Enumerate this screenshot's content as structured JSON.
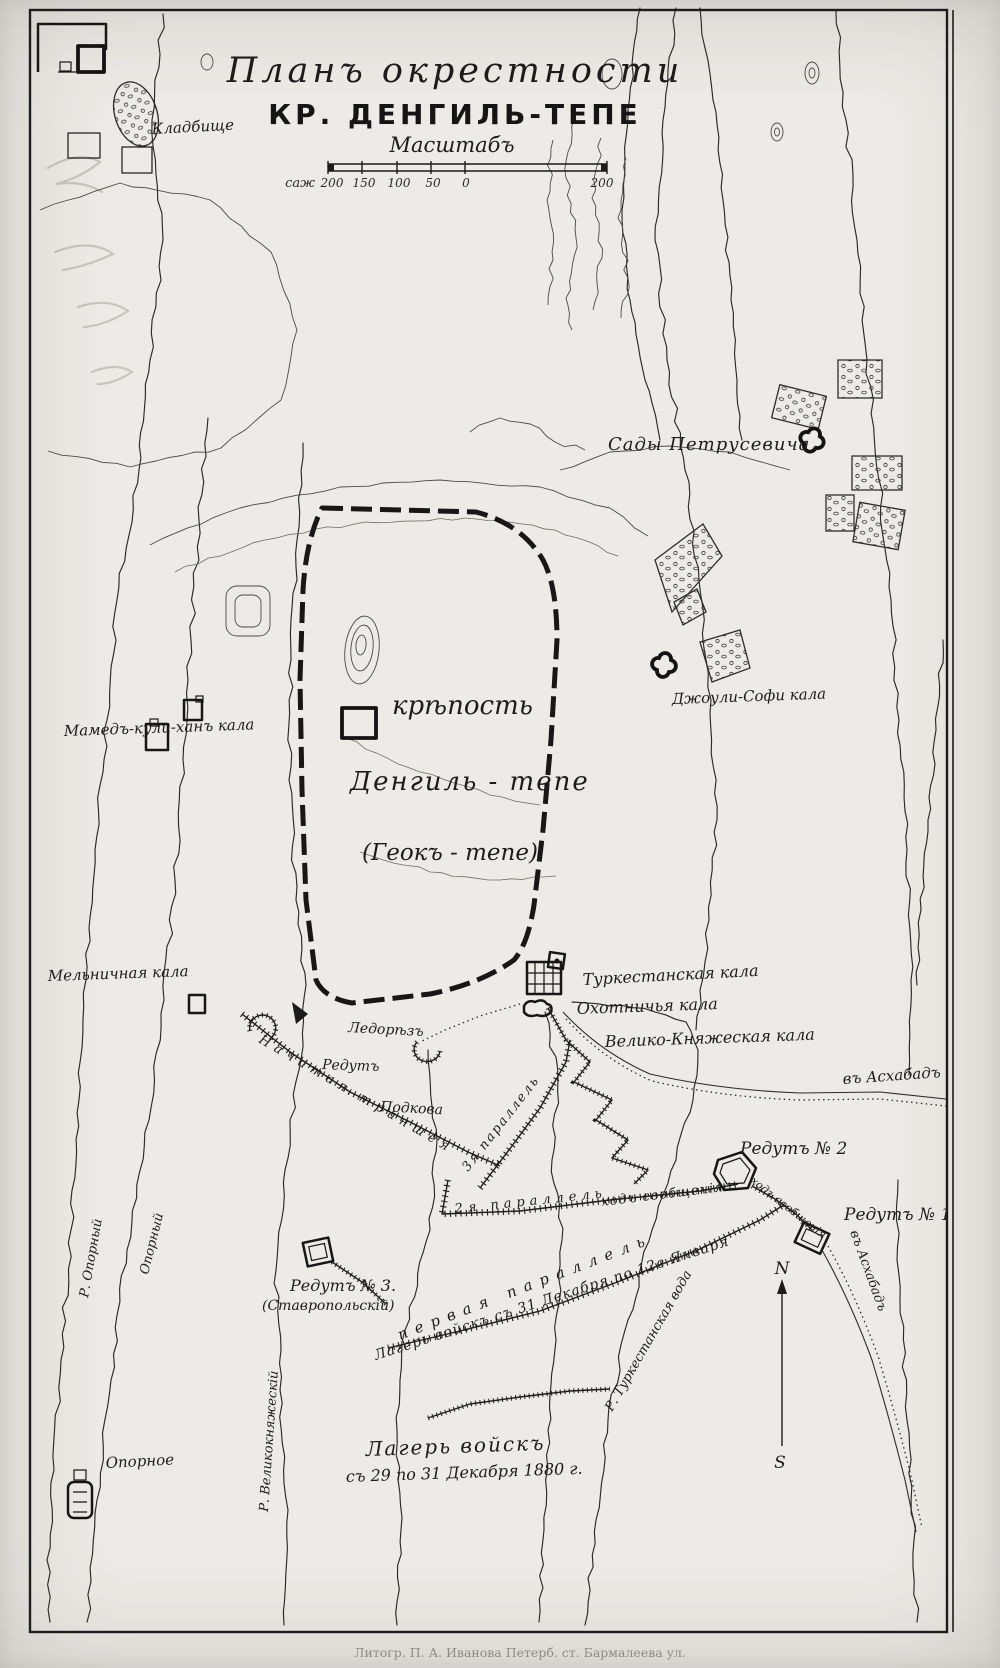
{
  "title": {
    "line1": "Планъ окрестности",
    "line2": "КР. ДЕНГИЛЬ-ТЕПЕ",
    "scale_heading": "Масштабъ"
  },
  "scale_bar": {
    "unit": "саж",
    "tick_200": "200",
    "tick_150": "150",
    "tick_100": "100",
    "tick_50": "50",
    "tick_0": "0",
    "right_end": "200"
  },
  "labels": {
    "cemetery": "Кладбище",
    "petrusevich_gardens": "Сады Петрусевича",
    "fortress_word": "крѣпость",
    "fortress_name": "Денгиль - тепе",
    "fortress_alt_name": "(Геокъ - тепе)",
    "mamed_kuli_khan_kala": "Мамедъ-кули-ханъ кала",
    "dzhouli_sofi_kala": "Джоули-Софи кала",
    "melnichnaya_kala": "Мельничная кала",
    "turkestanskaya_kala": "Туркестанская кала",
    "okhotnichya_kala": "Охотничья кала",
    "veliko_knyazheskaya_kala": "Велико-Княжеская кала",
    "ledorez": "Ледорѣзъ",
    "redut": "Редутъ",
    "podkova": "Подкова",
    "nachataya_transheya": "Начатая траншея",
    "parallel_3": "3я параллель",
    "parallel_2": "2я параллель",
    "khod_soobshcheniya": "ходъ сообщенія",
    "khod_soobshcheniya_2": "ходъ сообщенія",
    "redut_2": "Редутъ № 2",
    "redut_1": "Редутъ № 1",
    "redut_3": "Редутъ № 3.",
    "redut_3_sub": "(Ставропольскій)",
    "pervaya_parallel": "первая параллель",
    "camp_dec31_jan12": "Лагерь войскъ съ 31 Декабря по 12е Января",
    "camp_dec29_line1": "Лагерь войскъ",
    "camp_dec29_line2": "съ 29 по 31 Декабря 1880 г.",
    "opornoe": "Опорное",
    "r_oporny": "Р. Опорный",
    "oporny": "Опорный",
    "r_velikoknyazhesky": "Р. Великокняжескій",
    "r_turkestanskaya_voda": "Р. Туркестанская вода",
    "to_askhabad_east": "въ Асхабадъ",
    "to_askhabad_south": "въ Асхабадъ"
  },
  "compass": {
    "north": "N",
    "south": "S"
  },
  "footer": {
    "caption": "Литогр. П. А. Иванова Петерб. ст. Бармалеева ул."
  },
  "colors": {
    "paper": "#edebe7",
    "ink": "#1c1c1c",
    "pencil": "#c7c5bf"
  }
}
